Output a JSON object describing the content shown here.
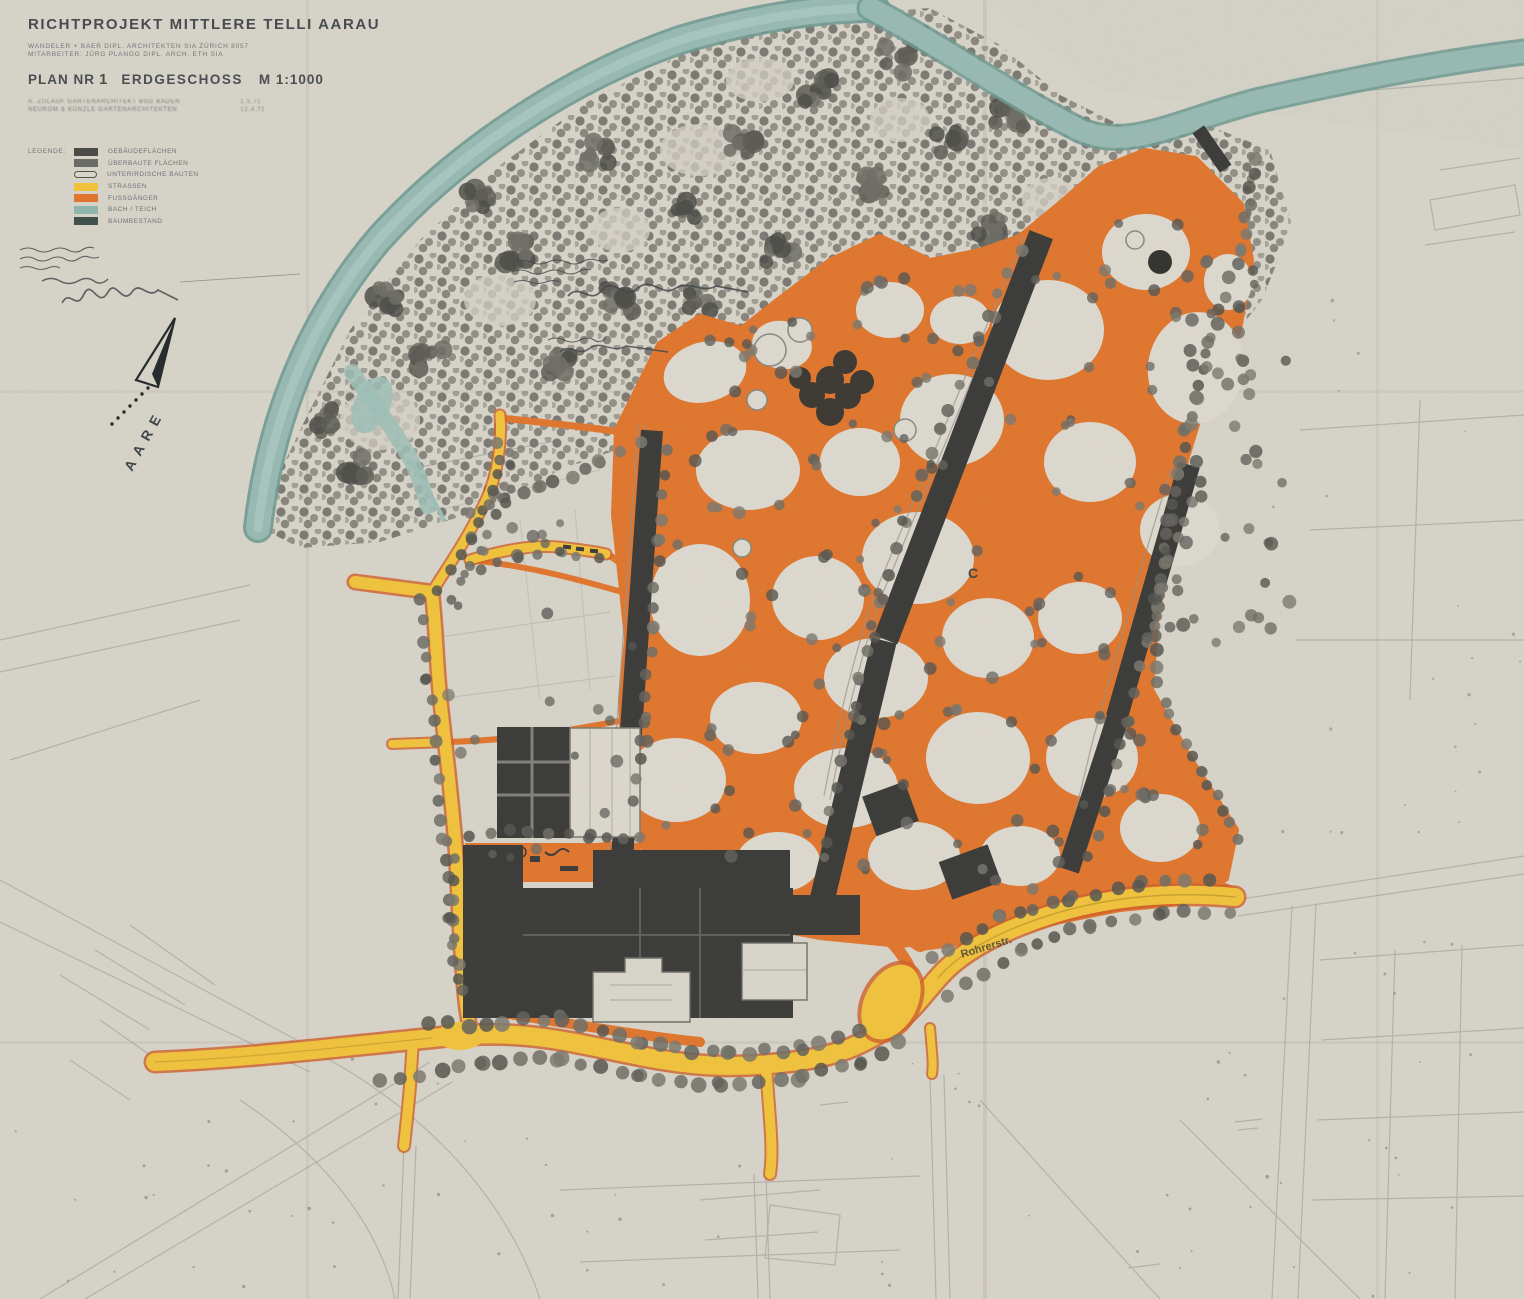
{
  "title_block": {
    "title": "RICHTPROJEKT MITTLERE TELLI AARAU",
    "credit_line_1": "WANDELER + BAER  DIPL. ARCHITEKTEN SIA  ZÜRICH  8057",
    "credit_line_2": "MITARBEITER: JÜRG PLANGG  DIPL. ARCH. ETH SIA",
    "plan_label": "PLAN NR",
    "plan_number": "1",
    "plan_name": "ERDGESCHOSS",
    "scale": "M 1:1000",
    "sub_line_1": "A. ZULAUF  GARTENARCHITEKT  BSG  BADEN",
    "sub_line_2": "NEUKOM & KÜNZLE  GARTENARCHITEKTEN",
    "date_note_1": "1.5.71",
    "date_note_2": "12.4.71"
  },
  "legend": {
    "heading": "LEGENDE:",
    "items": [
      {
        "label": "GEBÄUDEFLÄCHEN",
        "swatch": "#4a4a47",
        "type": "solid"
      },
      {
        "label": "ÜBERBAUTE FLÄCHEN",
        "swatch": "#6b6b67",
        "type": "solid"
      },
      {
        "label": "UNTERIRDISCHE BAUTEN",
        "swatch": "#d8d4ca",
        "type": "outline"
      },
      {
        "label": "STRASSEN",
        "swatch": "#f0c33c",
        "type": "solid"
      },
      {
        "label": "FUSSGÄNGER",
        "swatch": "#e0762e",
        "type": "solid"
      },
      {
        "label": "BACH / TEICH",
        "swatch": "#8fb6ae",
        "type": "solid"
      },
      {
        "label": "BAUMBESTAND",
        "swatch": "#41504c",
        "type": "solid"
      }
    ]
  },
  "map": {
    "labels": {
      "river": "AARE",
      "road": "Rohrerstr.",
      "marker_c": "C"
    }
  },
  "colors": {
    "paper": "#d7d3c9",
    "paper_light": "#ddd9cf",
    "river": "#9abcb4",
    "river_edge": "#6f9a92",
    "pedestrian_orange": "#e0762e",
    "street_yellow": "#f0c33c",
    "street_fringe": "#cf5f2a",
    "building_dark": "#3b3b39",
    "tree_gray": "#63625c",
    "linework_gray": "#7d8886"
  }
}
